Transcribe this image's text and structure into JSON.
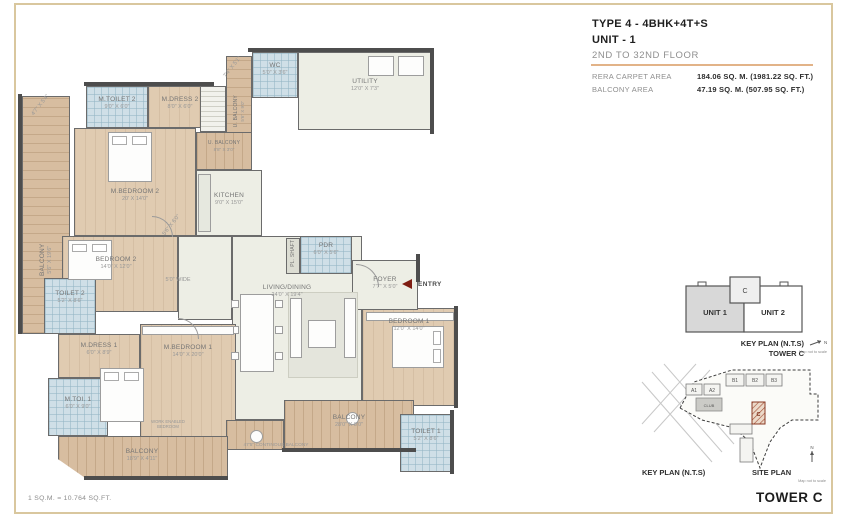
{
  "header": {
    "title": "TYPE 4 - 4BHK+4T+S",
    "unit": "UNIT - 1",
    "floors": "2ND TO 32ND FLOOR",
    "areas": [
      {
        "label": "RERA CARPET AREA",
        "value": "184.06 SQ. M. (1981.22 SQ. FT.)"
      },
      {
        "label": "BALCONY AREA",
        "value": "47.19 SQ. M. (507.95 SQ. FT.)"
      }
    ]
  },
  "plan": {
    "balcony_left": {
      "name": "BALCONY",
      "dims": "5'6\" X 19'6\""
    },
    "diag_tl": {
      "dims": "4'7\" X 5'4\""
    },
    "m_toilet_2": {
      "name": "M.TOILET 2",
      "dims": "9'0\" X 6'0\""
    },
    "m_dress_2": {
      "name": "M.DRESS 2",
      "dims": "8'0\" X 6'0\""
    },
    "diag_wc": {
      "dims": "7'4\" X 5'1\""
    },
    "wc": {
      "name": "WC",
      "dims": "5'0\" X 3'6\""
    },
    "u_balcony_v": {
      "name": "U. BALCONY",
      "dims": "5'6\" X 9'0\""
    },
    "utility": {
      "name": "UTILITY",
      "dims": "12'0\" X 7'3\""
    },
    "u_balcony_h": {
      "name": "U. BALCONY",
      "dims": "8'8\" X 3'0\""
    },
    "kitchen": {
      "name": "KITCHEN",
      "dims": "9'0\" X 15'0\""
    },
    "m_bedroom_2": {
      "name": "M.BEDROOM 2",
      "dims": "20' X 14'0\""
    },
    "diag_pass": {
      "dims": "5'6\" X 6'0\""
    },
    "bedroom_2": {
      "name": "BEDROOM 2",
      "dims": "14'0\" X 12'0\""
    },
    "passage": {
      "name": "5'0\" WIDE"
    },
    "living_dining": {
      "name": "LIVING/DINING",
      "dims": "24'0\" X 19'4\""
    },
    "pl_shaft": {
      "name": "PL. SHAFT"
    },
    "pdr": {
      "name": "PDR",
      "dims": "6'0\" X 5'6\""
    },
    "foyer": {
      "name": "FOYER",
      "dims": "7'7\" X 5'0\""
    },
    "entry": {
      "name": "ENTRY"
    },
    "bedroom_1": {
      "name": "BEDROOM 1",
      "dims": "12'0\" X 14'0\""
    },
    "toilet_2": {
      "name": "TOILET 2",
      "dims": "5'2\" X 8'6\""
    },
    "m_dress_1": {
      "name": "M.DRESS 1",
      "dims": "6'0\" X 8'9\""
    },
    "m_bedroom_1": {
      "name": "M.BEDROOM 1",
      "dims": "14'0\" X 20'0\""
    },
    "m_toi_1": {
      "name": "M.TOI. 1",
      "dims": "6'0\" X 9'0\""
    },
    "work_note": {
      "name": "WORK ENABLED BEDROOM"
    },
    "balcony_bl": {
      "name": "BALCONY",
      "dims": "18'9\" X 4'11\""
    },
    "cont_balcony": {
      "name": "47'5\" CONTINOUS BALCONY"
    },
    "balcony_br": {
      "name": "BALCONY",
      "dims": "28'0\" X 8'0\""
    },
    "toilet_1": {
      "name": "TOILET 1",
      "dims": "5'2\" X 8'6\""
    }
  },
  "key_plan": {
    "core": "C",
    "unit_1": "UNIT 1",
    "unit_2": "UNIT 2",
    "caption_line1": "KEY PLAN (N.T.S)",
    "caption_line2": "TOWER C",
    "north": "N",
    "scale_note": "Map not to scale"
  },
  "site_plan": {
    "a1": "A1",
    "a2": "A2",
    "b1": "B1",
    "b2": "B2",
    "b3": "B3",
    "club": "CLUB",
    "tower_c": "C",
    "caption_left": "KEY PLAN (N.T.S)",
    "caption_right": "SITE PLAN",
    "north": "N",
    "scale_note": "Map not to scale"
  },
  "footer": {
    "conversion": "1 SQ.M. = 10.764 SQ.FT.",
    "tower": "TOWER C"
  },
  "colors": {
    "frame": "#d9c79e",
    "accent_divider": "#e2b388",
    "wall": "#4d4d4d",
    "wood": "#d7bda0",
    "tile": "#cfdfe7",
    "entry_arrow": "#7e1d12"
  }
}
